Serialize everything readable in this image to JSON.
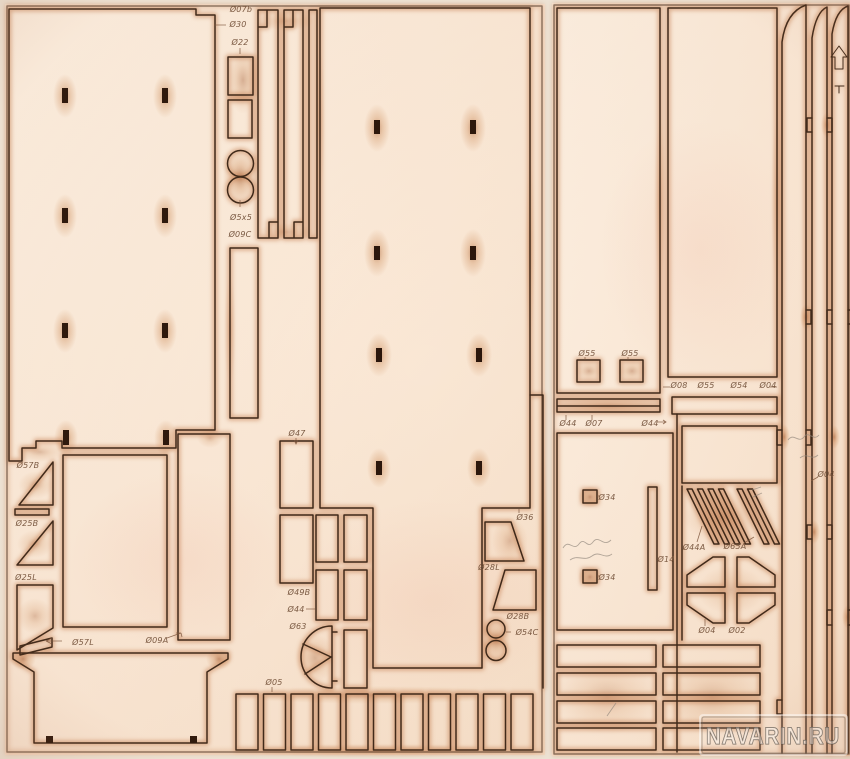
{
  "scene": {
    "description": "Photo of laser-cut plywood model ship kit part sheets",
    "watermark": "NAVARIN.RU"
  },
  "colors": {
    "background": "#efe7da",
    "sheet": "#fbeddd",
    "sheet_warm": "#f6ddc6",
    "cut_line": "#3c2718",
    "burn_glow": "#bf7544",
    "scorch": "#a85a2e",
    "label_ink": "#6b4a33",
    "slot_fill": "#2a160b",
    "pencil": "#938a80",
    "watermark_ink": "#5f564c"
  },
  "engravings": {
    "strip_arrow": "up-arrow"
  },
  "sheet1": {
    "labels": [
      {
        "t": "Ø07b",
        "x": 241,
        "y": 12
      },
      {
        "t": "Ø30",
        "x": 238,
        "y": 27
      },
      {
        "t": "Ø22",
        "x": 240,
        "y": 45
      },
      {
        "t": "Ø5x5",
        "x": 241,
        "y": 220
      },
      {
        "t": "Ø09C",
        "x": 240,
        "y": 237
      },
      {
        "t": "Ø57B",
        "x": 28,
        "y": 468
      },
      {
        "t": "Ø25B",
        "x": 27,
        "y": 526
      },
      {
        "t": "Ø25L",
        "x": 26,
        "y": 580
      },
      {
        "t": "Ø57L",
        "x": 83,
        "y": 645
      },
      {
        "t": "Ø09A",
        "x": 157,
        "y": 643
      },
      {
        "t": "Ø47",
        "x": 297,
        "y": 436
      },
      {
        "t": "Ø49B",
        "x": 299,
        "y": 595
      },
      {
        "t": "Ø44",
        "x": 296,
        "y": 612
      },
      {
        "t": "Ø63",
        "x": 298,
        "y": 629
      },
      {
        "t": "Ø05",
        "x": 274,
        "y": 685
      },
      {
        "t": "Ø36",
        "x": 525,
        "y": 520
      },
      {
        "t": "Ø28L",
        "x": 489,
        "y": 570
      },
      {
        "t": "Ø28B",
        "x": 518,
        "y": 619
      },
      {
        "t": "Ø54C",
        "x": 527,
        "y": 635
      }
    ]
  },
  "sheet2": {
    "labels": [
      {
        "t": "Ø55",
        "x": 587,
        "y": 356
      },
      {
        "t": "Ø55",
        "x": 630,
        "y": 356
      },
      {
        "t": "Ø08",
        "x": 679,
        "y": 388
      },
      {
        "t": "Ø55",
        "x": 706,
        "y": 388
      },
      {
        "t": "Ø54",
        "x": 739,
        "y": 388
      },
      {
        "t": "Ø04",
        "x": 768,
        "y": 388
      },
      {
        "t": "Ø44",
        "x": 568,
        "y": 426
      },
      {
        "t": "Ø07",
        "x": 594,
        "y": 426
      },
      {
        "t": "Ø44",
        "x": 650,
        "y": 426
      },
      {
        "t": "Ø34",
        "x": 607,
        "y": 500
      },
      {
        "t": "Ø34",
        "x": 607,
        "y": 580
      },
      {
        "t": "Ø14",
        "x": 666,
        "y": 562
      },
      {
        "t": "Ø44A",
        "x": 694,
        "y": 550
      },
      {
        "t": "Ø65A",
        "x": 735,
        "y": 549
      },
      {
        "t": "Ø04",
        "x": 707,
        "y": 633
      },
      {
        "t": "Ø02",
        "x": 737,
        "y": 633
      },
      {
        "t": "Ø04",
        "x": 826,
        "y": 477
      }
    ]
  }
}
